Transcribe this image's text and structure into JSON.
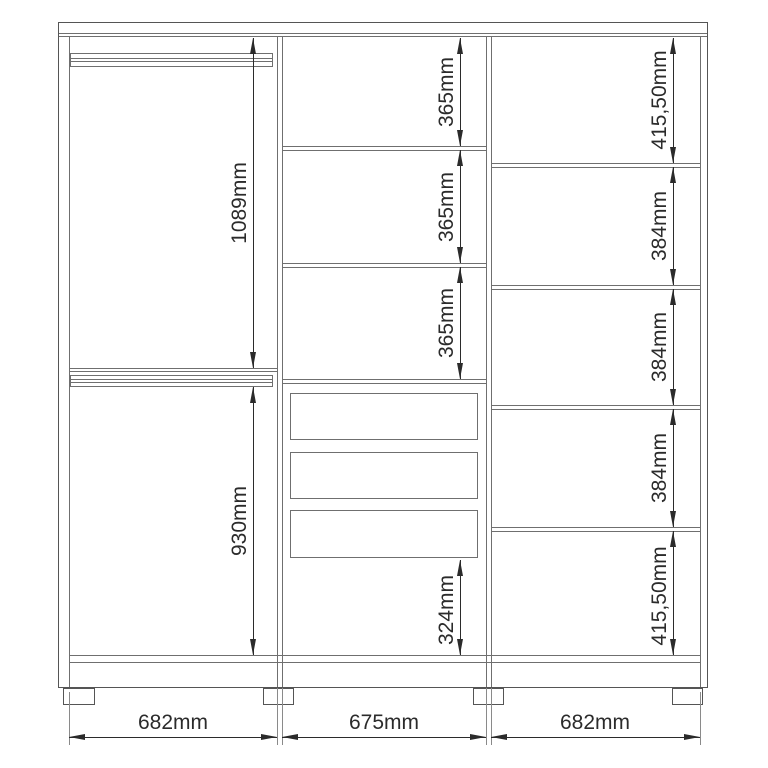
{
  "diagram_type": "wardrobe-dimension-drawing",
  "colors": {
    "background": "#ffffff",
    "structure_line": "#6f6f6f",
    "frame_line": "#555555",
    "dimension_line": "#2b2b2b",
    "label_text": "#2b2b2b"
  },
  "cabinet": {
    "left_section": {
      "features": [
        "hanging-rail-top",
        "hanging-rail-middle",
        "shelf"
      ],
      "dims": {
        "upper": "1089mm",
        "lower": "930mm"
      }
    },
    "middle_section": {
      "features": [
        "shelf",
        "shelf",
        "shelf",
        "drawer",
        "drawer",
        "drawer"
      ],
      "drawer_count": 3,
      "dims": {
        "shelf1": "365mm",
        "shelf2": "365mm",
        "shelf3": "365mm",
        "bottom": "324mm"
      }
    },
    "right_section": {
      "features": [
        "shelf",
        "shelf",
        "shelf",
        "shelf"
      ],
      "dims": {
        "s1": "415,50mm",
        "s2": "384mm",
        "s3": "384mm",
        "s4": "384mm",
        "s5": "415,50mm"
      }
    },
    "widths": {
      "left": "682mm",
      "center": "675mm",
      "right": "682mm"
    },
    "leg_count": 4
  }
}
